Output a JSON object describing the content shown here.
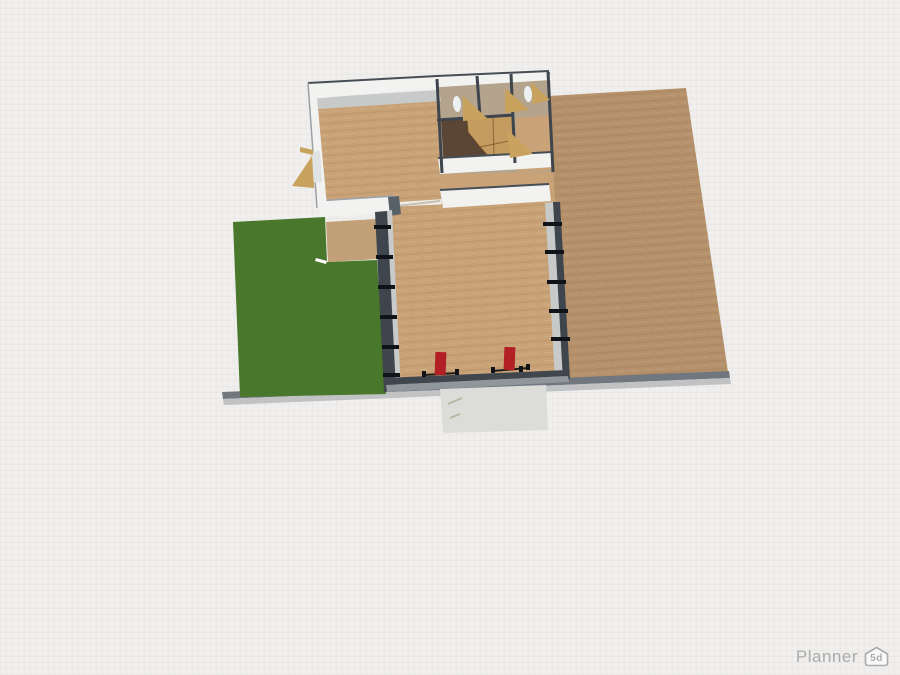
{
  "watermark": {
    "brand": "Planner",
    "badge": "5d"
  },
  "colors": {
    "background": "#f0efed",
    "grass": "#49772c",
    "floor": "#c9a377",
    "terrain": "#b5916c",
    "porch": "#c2a078",
    "wall_white": "#f2f2f1",
    "wall_face": "#c8cac9",
    "wall_dark": "#3e454c",
    "wall_corner": "#596168",
    "bottom_wall_dark": "#3f464d",
    "bottom_wall_gray": "#8f969c",
    "curb_dark": "#70777e",
    "curb_light": "#c0c2c4",
    "patio": "#dcdcd9",
    "rooms_base": "#b5a48d",
    "dark_room": "#5b4534",
    "stair_tan": "#c49b61",
    "door_tan": "#c9a25e",
    "fixture_white": "#edf0f1",
    "window_gap": "#dfe3e4",
    "chair_red": "#b22025",
    "lawn_object_white": "#ffffff"
  }
}
